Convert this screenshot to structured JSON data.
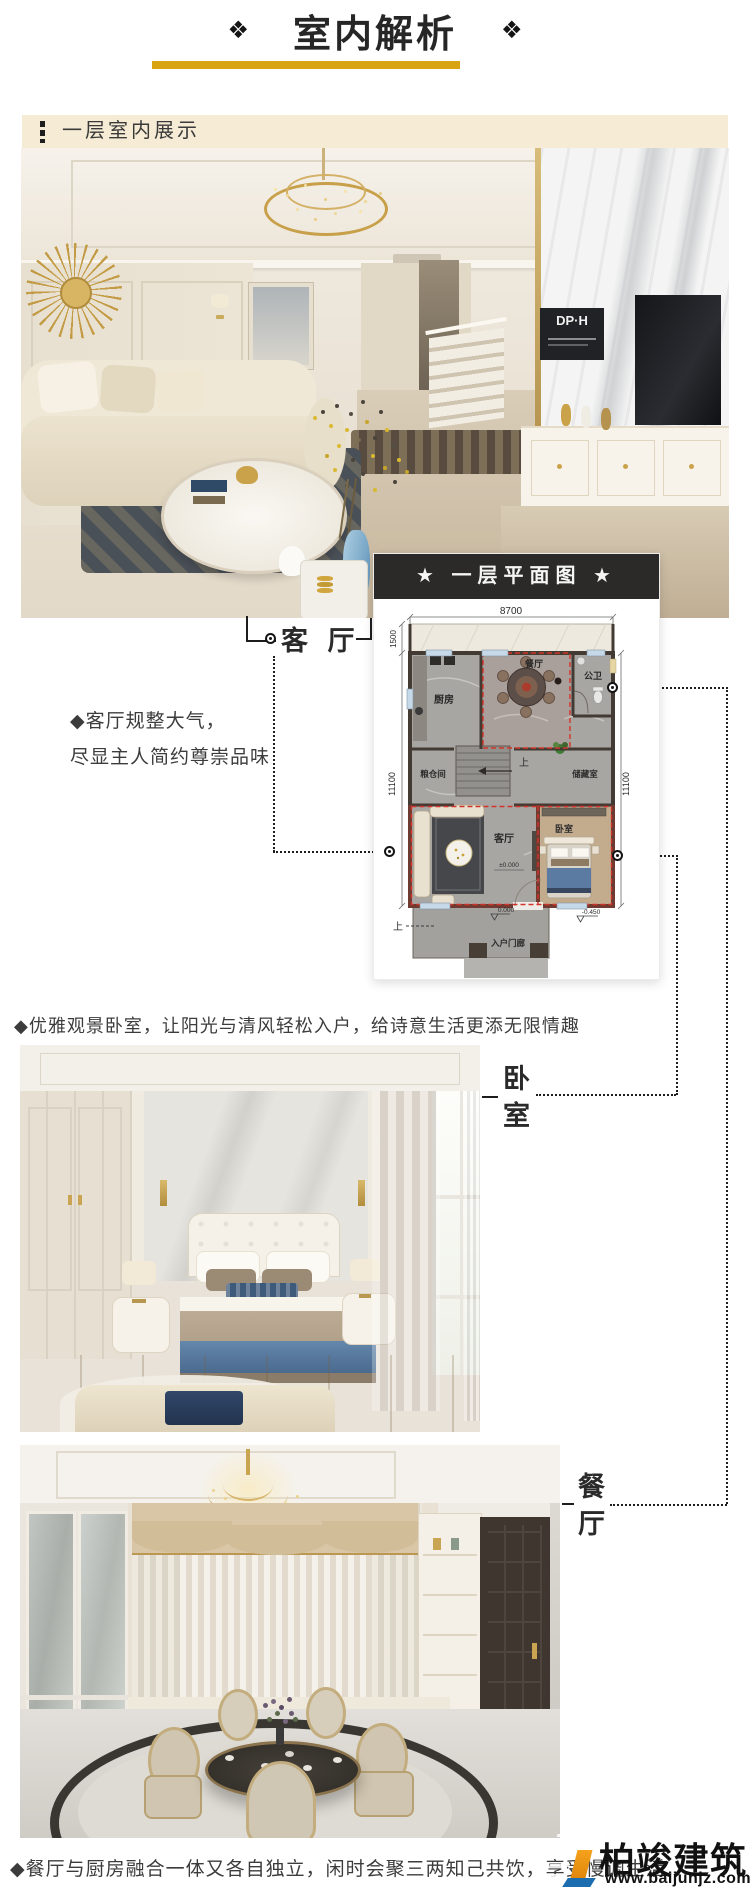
{
  "header": {
    "ornament": "❖",
    "title": "室内解析"
  },
  "section": {
    "title": "一层室内展示"
  },
  "living_photo": {
    "plaque": "DP·H"
  },
  "plan": {
    "title": "★ 一层平面图 ★",
    "dims": {
      "top": "8700",
      "terrace": "1500",
      "left": "11100",
      "right": "11100"
    },
    "rooms": {
      "kitchen": "厨房",
      "dining": "餐厅",
      "bath": "公卫",
      "grain": "粮仓间",
      "storage": "储藏室",
      "living": "客厅",
      "bedroom": "卧室",
      "porch": "入户门廊"
    },
    "marks": {
      "up_stairs": "上",
      "up_entry": "上",
      "level_living": "±0.000",
      "level_porch": "0.000",
      "level_yard": "-0.450"
    }
  },
  "callouts": {
    "living": {
      "label": "客 厅",
      "desc1": "◆客厅规整大气，",
      "desc2": "尽显主人简约尊崇品味"
    },
    "bedroom": {
      "label": "卧室",
      "desc": "◆优雅观景卧室，让阳光与清风轻松入户，给诗意生活更添无限情趣"
    },
    "dining": {
      "label": "餐厅",
      "desc": "◆餐厅与厨房融合一体又各自独立，闲时会聚三两知己共饮，享受慢调生活"
    }
  },
  "watermark": {
    "brand": "柏竣建筑",
    "site": "www.baijunjz.com"
  }
}
